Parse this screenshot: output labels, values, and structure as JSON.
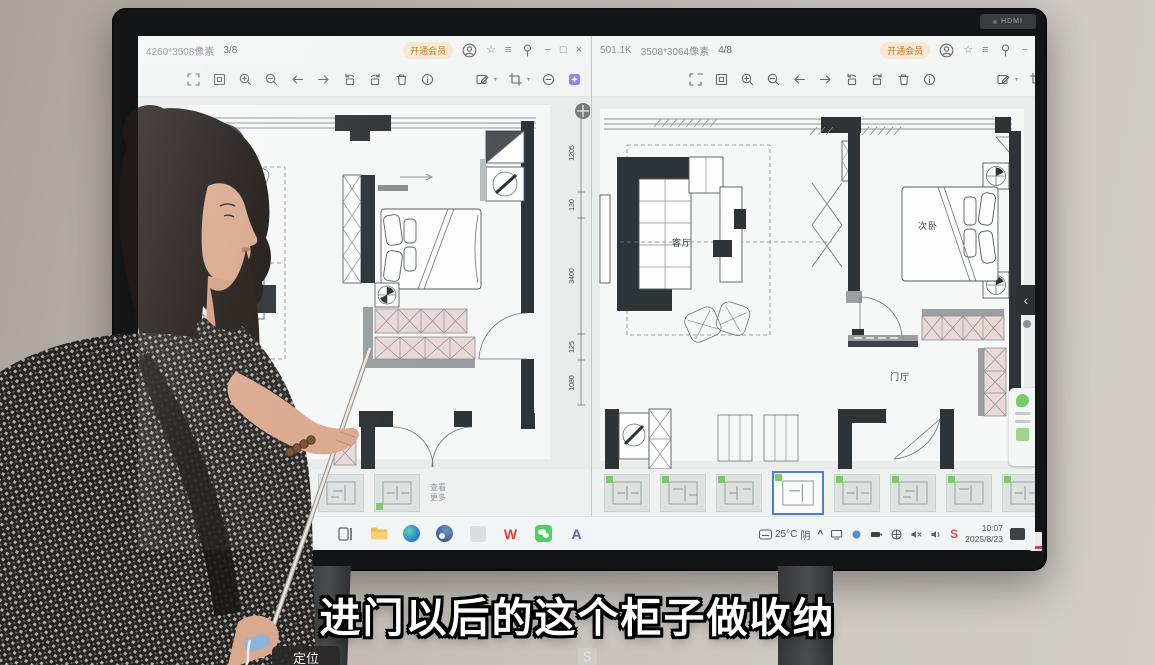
{
  "tv": {
    "hdmi_label": "HDMI"
  },
  "overlay": {
    "subtitle": "进门以后的这个柜子做收纳",
    "locate_label": "定位",
    "watermark_s": "S"
  },
  "icons": {
    "close": "×",
    "minimize": "−",
    "restore": "□",
    "menu": "≡",
    "star": "☆",
    "chevron_left": "‹",
    "chevron_up": "^",
    "caret": "▾"
  },
  "left_window": {
    "title_resolution": "4260*3508像素",
    "title_page": "3/8",
    "vip_label": "开通会员",
    "badge_name": "飞享",
    "badge_count": "(0)",
    "dim_labels": [
      "1205",
      "130",
      "3400",
      "125",
      "1080"
    ],
    "thumbs_more_1": "查看",
    "thumbs_more_2": "更多"
  },
  "right_window": {
    "title_filesize": "501.1K",
    "title_resolution": "3508*3064像素",
    "title_page": "4/8",
    "vip_label": "开通会员",
    "room_living": "客厅",
    "room_bedroom": "次卧",
    "room_hall": "门厅"
  },
  "taskbar": {
    "weather_temp": "25°C",
    "weather_cond": "阴",
    "clock_time": "10:07",
    "clock_date": "2025/8/23",
    "wps_letter": "W",
    "app_a_letter": "A",
    "tray_s": "S"
  }
}
